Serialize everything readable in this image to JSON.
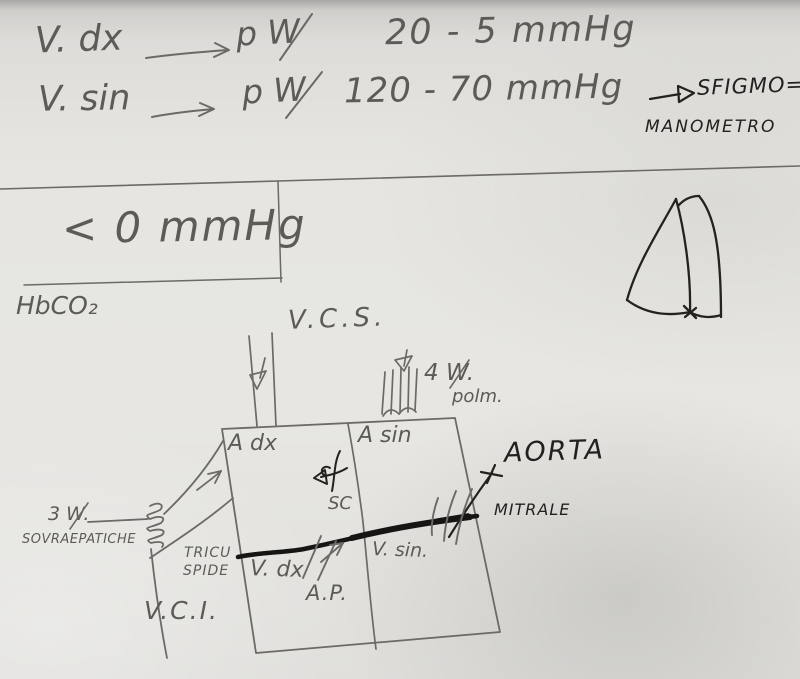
{
  "colors": {
    "paper": "#e6e5e1",
    "pencil": "#6b6a67",
    "ink": "#23221f"
  },
  "pressure_notes": {
    "row1": {
      "label": "V. dx",
      "target": "p W",
      "value": "20 - 5 mmHg"
    },
    "row2": {
      "label": "V. sin",
      "target": "p W",
      "value": "120 - 70 mmHg",
      "device_line1": "SFIGMO=",
      "device_line2": "MANOMETRO"
    },
    "venous_box_value": "< 0 mmHg",
    "molecule": "HbCO₂"
  },
  "heart_diagram": {
    "vena_cava_superior": "V.C.S.",
    "pulmonary_veins_count": "4 W.",
    "pulmonary_veins_word": "polm.",
    "right_atrium": "A dx",
    "left_atrium": "A sin",
    "aorta": "AORTA",
    "mitral_valve": "MITRALE",
    "coronary_sinus": "SC",
    "tricuspid_line1": "TRICU",
    "tricuspid_line2": "SPIDE",
    "right_ventricle": "V. dx",
    "left_ventricle": "V. sin.",
    "pulmonary_artery": "A.P.",
    "vena_cava_inferior": "V.C.I.",
    "hepatic_veins_count": "3 W.",
    "hepatic_veins_word": "SOVRAEPATICHE"
  }
}
